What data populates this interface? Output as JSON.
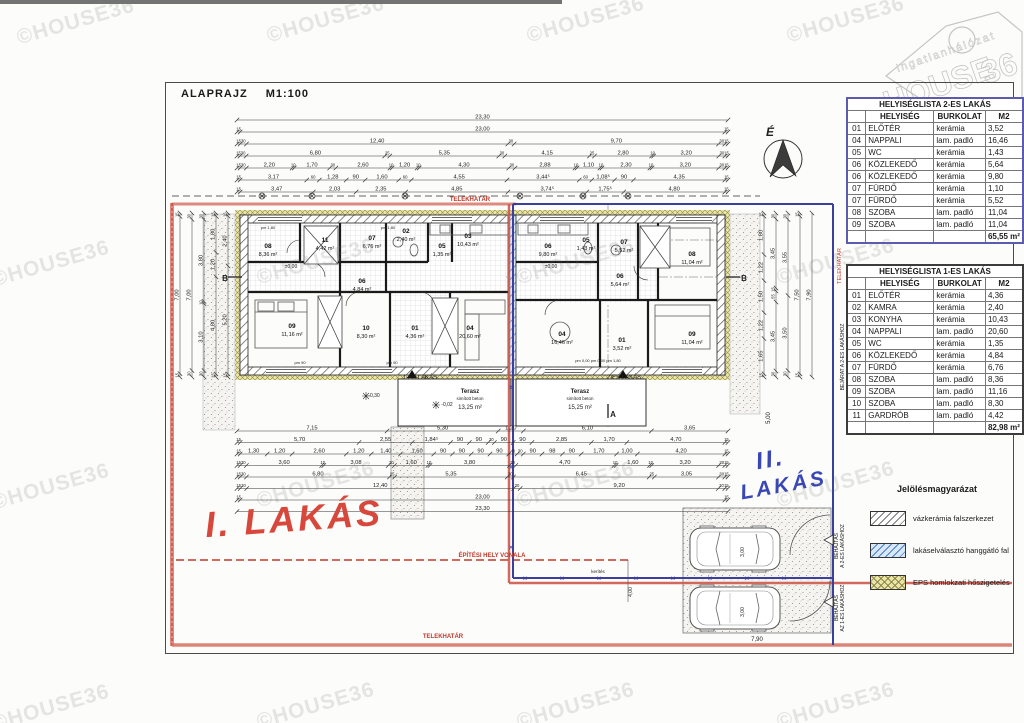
{
  "page": {
    "title": "ALAPRAJZ M1:100",
    "watermark": "©HOUSE36"
  },
  "logo": {
    "brand_top": "ingatlanhálózat",
    "brand_main": "HOUSE",
    "brand_suffix": "36"
  },
  "colors": {
    "boundary_red": "#c74a3e",
    "boundary_blue": "#3b3f9e",
    "hatch_blue": "#4a7fc0",
    "eps_yellow": "#ece7a8",
    "handwrite_red": "#d8473b",
    "handwrite_blue": "#3946b5"
  },
  "tables": [
    {
      "title": "HELYISÉGLISTA 2-ES LAKÁS",
      "headers": [
        "HELYISÉG",
        "BURKOLAT",
        "M2"
      ],
      "rows": [
        [
          "01",
          "ELŐTÉR",
          "kerámia",
          "3,52"
        ],
        [
          "04",
          "NAPPALI",
          "lam. padló",
          "16,46"
        ],
        [
          "05",
          "WC",
          "kerámia",
          "1,43"
        ],
        [
          "06",
          "KÖZLEKEDŐ",
          "kerámia",
          "5,64"
        ],
        [
          "06",
          "KÖZLEKEDŐ",
          "kerámia",
          "9,80"
        ],
        [
          "07",
          "FÜRDŐ",
          "kerámia",
          "1,10"
        ],
        [
          "07",
          "FÜRDŐ",
          "kerámia",
          "5,52"
        ],
        [
          "08",
          "SZOBA",
          "lam. padló",
          "11,04"
        ],
        [
          "09",
          "SZOBA",
          "lam. padló",
          "11,04"
        ]
      ],
      "total": "65,55 m²"
    },
    {
      "title": "HELYISÉGLISTA 1-ES LAKÁS",
      "headers": [
        "HELYISÉG",
        "BURKOLAT",
        "M2"
      ],
      "rows": [
        [
          "01",
          "ELŐTÉR",
          "kerámia",
          "4,36"
        ],
        [
          "02",
          "KAMRA",
          "kerámia",
          "2,40"
        ],
        [
          "03",
          "KONYHA",
          "kerámia",
          "10,43"
        ],
        [
          "04",
          "NAPPALI",
          "lam. padló",
          "20,60"
        ],
        [
          "05",
          "WC",
          "kerámia",
          "1,35"
        ],
        [
          "06",
          "KÖZLEKEDŐ",
          "kerámia",
          "4,84"
        ],
        [
          "07",
          "FÜRDŐ",
          "kerámia",
          "6,76"
        ],
        [
          "08",
          "SZOBA",
          "lam. padló",
          "8,36"
        ],
        [
          "09",
          "SZOBA",
          "lam. padló",
          "11,16"
        ],
        [
          "10",
          "SZOBA",
          "lam. padló",
          "8,30"
        ],
        [
          "11",
          "GARDRÓB",
          "lam. padló",
          "4,42"
        ]
      ],
      "total": "82,98 m²"
    }
  ],
  "legend": {
    "title": "Jelölésmagyarázat",
    "items": [
      {
        "label": "vázkerámia falszerkezet",
        "type": "hatch-gray"
      },
      {
        "label": "lakáselválasztó hanggátló fal",
        "type": "hatch-blue"
      },
      {
        "label": "EPS homlokzati hőszigetelés",
        "type": "hatch-yellow"
      }
    ]
  },
  "plan": {
    "north_label": "É",
    "top_dims": [
      [
        "23,30"
      ],
      [
        "15",
        "23,00",
        "15"
      ],
      [
        "15",
        "30",
        "12,40",
        "30",
        "9,70",
        "30",
        "15"
      ],
      [
        "15",
        "30",
        "6,80",
        "25",
        "5,35",
        "30",
        "4,15",
        "25",
        "2,80",
        "10",
        "3,20",
        "30",
        "15"
      ],
      [
        "15",
        "30",
        "2,20",
        "10",
        "1,70",
        "30",
        "2,60",
        "10",
        "1,20",
        "10",
        "4,30",
        "30",
        "2,88",
        "10",
        "1,10",
        "10",
        "2,30",
        "10",
        "3,20",
        "30",
        "15"
      ],
      [
        "15",
        "3,17",
        "60",
        "1,28",
        "90",
        "1,60",
        "60",
        "4,55",
        "3,44⁵",
        "60",
        "1,08⁵",
        "90",
        "4,35",
        "15"
      ],
      [
        "15",
        "3,47",
        "2,03",
        "2,35",
        "4,85",
        "3,74⁵",
        "1,75⁵",
        "4,80",
        "15"
      ]
    ],
    "bottom_dims": [
      [
        "7,15",
        "5,30",
        "1,20",
        "6,10",
        "3,65"
      ],
      [
        "15",
        "5,70",
        "2,55",
        "1,84⁵",
        "90",
        "90",
        "30",
        "90",
        "90",
        "2,85",
        "1,70",
        "4,70",
        "15"
      ],
      [
        "15",
        "1,30",
        "1,20",
        "2,60",
        "1,20",
        "1,40",
        "1,60",
        "90",
        "90",
        "90",
        "90",
        "40",
        "30",
        "90",
        "98",
        "90",
        "1,70",
        "1,00",
        "4,20",
        "15"
      ],
      [
        "15",
        "30",
        "3,60",
        "10",
        "3,08",
        "30",
        "1,60",
        "10",
        "3,80",
        "30",
        "4,70",
        "10",
        "1,60",
        "10",
        "3,20",
        "30",
        "15"
      ],
      [
        "15",
        "30",
        "6,80",
        "25",
        "5,35",
        "30",
        "6,45",
        "25",
        "3,05",
        "30",
        "15"
      ],
      [
        "15",
        "30",
        "12,40",
        "30",
        "9,20",
        "30",
        "15"
      ],
      [
        "15",
        "23,00",
        "15"
      ],
      [
        "23,30"
      ]
    ],
    "left_dims": [
      {
        "x": 180,
        "vals": [
          "15",
          "7,00",
          "15"
        ]
      },
      {
        "x": 192,
        "vals": [
          "30",
          "7,00",
          "30"
        ]
      },
      {
        "x": 204,
        "vals": [
          "30",
          "3,80",
          "10",
          "3,10",
          "30"
        ]
      },
      {
        "x": 216,
        "vals": [
          "15",
          "1,80",
          "1,20",
          "4,80",
          "15"
        ]
      },
      {
        "x": 228,
        "vals": [
          "15",
          "2,40",
          "5,20",
          "15"
        ]
      }
    ],
    "right_dims": [
      {
        "x": 764,
        "vals": [
          "15",
          "1,80",
          "1,22",
          "1,50",
          "1,22",
          "1,65",
          "15"
        ]
      },
      {
        "x": 776,
        "vals": [
          "30",
          "3,45",
          "15",
          "55",
          "3,45",
          "30"
        ]
      },
      {
        "x": 788,
        "vals": [
          "30",
          "3,55",
          "3,50",
          "30"
        ]
      },
      {
        "x": 800,
        "vals": [
          "15",
          "7,50",
          "15"
        ]
      },
      {
        "x": 812,
        "vals": [
          "7,90"
        ]
      }
    ],
    "rooms": [
      {
        "n": "08",
        "a": "8,36 m²",
        "x": 268,
        "y": 248
      },
      {
        "n": "11",
        "a": "4,42 m²",
        "x": 325,
        "y": 242
      },
      {
        "n": "07",
        "a": "6,76 m²",
        "x": 372,
        "y": 240
      },
      {
        "n": "02",
        "a": "2,40 m²",
        "x": 406,
        "y": 233
      },
      {
        "n": "05",
        "a": "1,35 m²",
        "x": 442,
        "y": 248
      },
      {
        "n": "03",
        "a": "10,43 m²",
        "x": 468,
        "y": 238
      },
      {
        "n": "06",
        "a": "4,84 m²",
        "x": 362,
        "y": 283
      },
      {
        "n": "09",
        "a": "11,16 m²",
        "x": 292,
        "y": 328
      },
      {
        "n": "10",
        "a": "8,30 m²",
        "x": 366,
        "y": 330
      },
      {
        "n": "01",
        "a": "4,36 m²",
        "x": 415,
        "y": 330
      },
      {
        "n": "04",
        "a": "20,60 m²",
        "x": 470,
        "y": 330
      },
      {
        "n": "06",
        "a": "9,80 m²",
        "x": 548,
        "y": 248
      },
      {
        "n": "05",
        "a": "1,43 m²",
        "x": 586,
        "y": 242
      },
      {
        "n": "07",
        "a": "5,52 m²",
        "x": 624,
        "y": 244
      },
      {
        "n": "08",
        "a": "11,04 m²",
        "x": 692,
        "y": 256
      },
      {
        "n": "06",
        "a": "5,64 m²",
        "x": 620,
        "y": 278
      },
      {
        "n": "04",
        "a": "16,46 m²",
        "x": 562,
        "y": 336
      },
      {
        "n": "01",
        "a": "3,52 m²",
        "x": 622,
        "y": 342
      },
      {
        "n": "09",
        "a": "11,04 m²",
        "x": 692,
        "y": 336
      }
    ],
    "labels": [
      {
        "t": "TELEKHATÁR",
        "x": 470,
        "y": 201,
        "s": 6,
        "c": "#c0392b",
        "b": 1
      },
      {
        "t": "TELEKHATÁR",
        "x": 443,
        "y": 638,
        "s": 6,
        "c": "#c0392b",
        "b": 1
      },
      {
        "t": "TELEKHATÁR",
        "x": 841,
        "y": 266,
        "s": 5.5,
        "c": "#c0392b",
        "rot": -90
      },
      {
        "t": "ÉPÍTÉSI HELY VONALA",
        "x": 492,
        "y": 557,
        "s": 6,
        "c": "#c0392b",
        "b": 1
      },
      {
        "t": "1-ES LAKÁS",
        "x": 420,
        "y": 379,
        "s": 6
      },
      {
        "t": "2-ES LAKÁS",
        "x": 624,
        "y": 379,
        "s": 6
      },
      {
        "t": "Terasz",
        "x": 470,
        "y": 393,
        "s": 6,
        "b": 1
      },
      {
        "t": "simított beton",
        "x": 470,
        "y": 400,
        "s": 4.5
      },
      {
        "t": "13,25 m²",
        "x": 470,
        "y": 409,
        "s": 6
      },
      {
        "t": "Terasz",
        "x": 580,
        "y": 393,
        "s": 6,
        "b": 1
      },
      {
        "t": "simított beton",
        "x": 580,
        "y": 400,
        "s": 4.5
      },
      {
        "t": "15,25 m²",
        "x": 580,
        "y": 409,
        "s": 6
      },
      {
        "t": "±0,00",
        "x": 291,
        "y": 268,
        "s": 5
      },
      {
        "t": "±0,00",
        "x": 551,
        "y": 268,
        "s": 5
      },
      {
        "t": "-0,30",
        "x": 374,
        "y": 397,
        "s": 5
      },
      {
        "t": "-0,02",
        "x": 447,
        "y": 406,
        "s": 5
      },
      {
        "t": "5,00",
        "x": 770,
        "y": 418,
        "s": 6,
        "rot": -90
      },
      {
        "t": "3,00",
        "x": 744,
        "y": 552,
        "s": 5,
        "rot": -90
      },
      {
        "t": "3,00",
        "x": 744,
        "y": 612,
        "s": 5,
        "rot": -90
      },
      {
        "t": "7,90",
        "x": 757,
        "y": 641,
        "s": 6
      },
      {
        "t": "4,00",
        "x": 632,
        "y": 592,
        "s": 5,
        "rot": -90
      },
      {
        "t": "B",
        "x": 225,
        "y": 281,
        "s": 8,
        "b": 1
      },
      {
        "t": "B",
        "x": 744,
        "y": 281,
        "s": 8,
        "b": 1
      },
      {
        "t": "A",
        "x": 613,
        "y": 417,
        "s": 8,
        "b": 1
      },
      {
        "t": "pm 90",
        "x": 300,
        "y": 364,
        "s": 4
      },
      {
        "t": "pm 90",
        "x": 392,
        "y": 364,
        "s": 4
      },
      {
        "t": "pm 1,80",
        "x": 268,
        "y": 229,
        "s": 4
      },
      {
        "t": "pm 1,80",
        "x": 388,
        "y": 229,
        "s": 4
      },
      {
        "t": "pm 0,00 pm 0,00 pm 1,80",
        "x": 598,
        "y": 362,
        "s": 4
      },
      {
        "t": "kerítés",
        "x": 598,
        "y": 573,
        "s": 4.5
      }
    ],
    "handwritten": [
      {
        "text": "I. LAKÁS",
        "x": 205,
        "y": 498,
        "size": 36,
        "color": "#d8473b",
        "rot": -4
      },
      {
        "text": "II.",
        "x": 756,
        "y": 446,
        "size": 24,
        "color": "#3946b5",
        "rot": -10
      },
      {
        "text": "LAKÁS",
        "x": 740,
        "y": 474,
        "size": 21,
        "color": "#3946b5",
        "rot": -10
      }
    ],
    "side_texts": [
      {
        "lines": [
          "BEJÁRAT A 2-ES LAKÁSHOZ"
        ],
        "x": 841,
        "y": 432,
        "w": 150
      },
      {
        "lines": [
          "BEHAJTÁS",
          "A 2-ES LAKÁSHOZ"
        ],
        "x": 835,
        "y": 574,
        "w": 56
      },
      {
        "lines": [
          "BEHAJTÁS",
          "AZ 1-ES LAKÁSHOZ"
        ],
        "x": 835,
        "y": 638,
        "w": 60
      }
    ],
    "watermark_positions": [
      [
        15,
        10
      ],
      [
        265,
        8
      ],
      [
        525,
        8
      ],
      [
        785,
        8
      ],
      [
        -10,
        252
      ],
      [
        255,
        250
      ],
      [
        515,
        250
      ],
      [
        775,
        250
      ],
      [
        -10,
        475
      ],
      [
        255,
        473
      ],
      [
        515,
        473
      ],
      [
        775,
        473
      ],
      [
        -10,
        696
      ],
      [
        255,
        694
      ],
      [
        515,
        694
      ],
      [
        775,
        694
      ]
    ]
  }
}
